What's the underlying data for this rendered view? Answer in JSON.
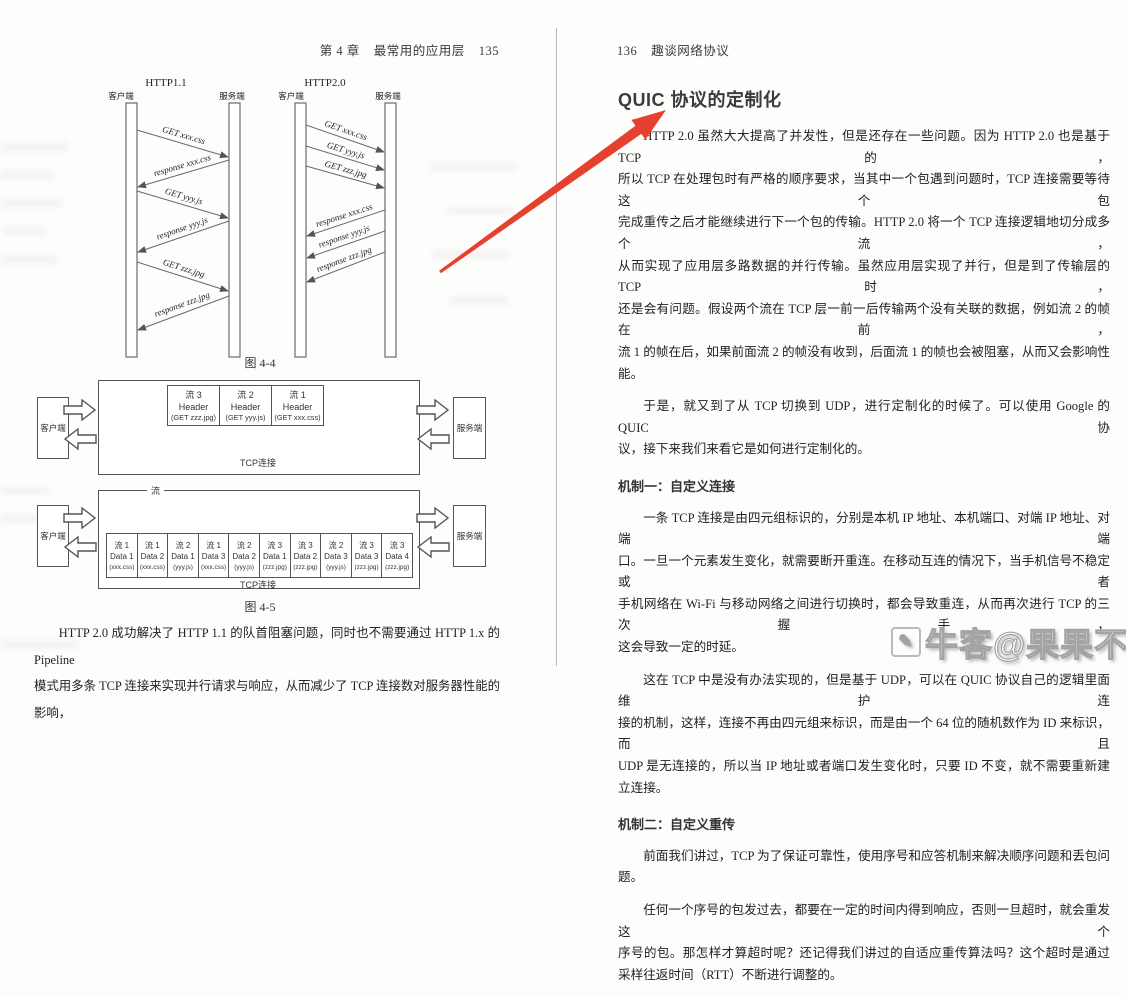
{
  "book": {
    "left_header": {
      "chapter": "第 4 章",
      "section": "最常用的应用层",
      "page": "135"
    },
    "right_header": {
      "page": "136",
      "title": "趣谈网络协议"
    }
  },
  "fig44": {
    "caption": "图 4-4",
    "http11": {
      "title": "HTTP1.1",
      "client": "客户端",
      "server": "服务端",
      "messages": [
        "GET xxx.css",
        "response xxx.css",
        "GET yyy.js",
        "response yyy.js",
        "GET zzz.jpg",
        "response zzz.jpg"
      ]
    },
    "http20": {
      "title": "HTTP2.0",
      "client": "客户端",
      "server": "服务端",
      "messages": [
        "GET xxx.css",
        "GET yyy.js",
        "GET zzz.jpg",
        "response xxx.css",
        "response yyy.js",
        "response zzz.jpg"
      ]
    }
  },
  "fig45": {
    "caption": "图 4-5",
    "client": "客户端",
    "server": "服务端",
    "tcp_label": "TCP连接",
    "stream_label": "流",
    "header_boxes": [
      {
        "stream": "流 3",
        "mid": "Header",
        "payload": "(GET zzz.jpg)"
      },
      {
        "stream": "流 2",
        "mid": "Header",
        "payload": "(GET yyy.js)"
      },
      {
        "stream": "流 1",
        "mid": "Header",
        "payload": "(GET xxx.css)"
      }
    ],
    "data_boxes": [
      {
        "stream": "流 1",
        "mid": "Data 1",
        "payload": "(xxx.css)"
      },
      {
        "stream": "流 1",
        "mid": "Data 2",
        "payload": "(xxx.css)"
      },
      {
        "stream": "流 2",
        "mid": "Data 1",
        "payload": "(yyy.js)"
      },
      {
        "stream": "流 1",
        "mid": "Data 3",
        "payload": "(xxx.css)"
      },
      {
        "stream": "流 2",
        "mid": "Data 2",
        "payload": "(yyy.js)"
      },
      {
        "stream": "流 3",
        "mid": "Data 1",
        "payload": "(zzz.jpg)"
      },
      {
        "stream": "流 3",
        "mid": "Data 2",
        "payload": "(zzz.jpg)"
      },
      {
        "stream": "流 2",
        "mid": "Data 3",
        "payload": "(yyy.js)"
      },
      {
        "stream": "流 3",
        "mid": "Data 3",
        "payload": "(zzz.jpg)"
      },
      {
        "stream": "流 3",
        "mid": "Data 4",
        "payload": "(zzz.jpg)"
      }
    ]
  },
  "left_text": {
    "lines": [
      "HTTP 2.0 成功解决了 HTTP 1.1 的队首阻塞问题，同时也不需要通过 HTTP 1.x 的 Pipeline",
      "模式用多条 TCP 连接来实现并行请求与响应，从而减少了 TCP 连接数对服务器性能的影响，"
    ]
  },
  "right_page": {
    "title": "QUIC 协议的定制化",
    "p1": {
      "lines": [
        "HTTP 2.0 虽然大大提高了并发性，但是还存在一些问题。因为 HTTP 2.0 也是基于 TCP 的，",
        "所以 TCP 在处理包时有严格的顺序要求，当其中一个包遇到问题时，TCP 连接需要等待这个包",
        "完成重传之后才能继续进行下一个包的传输。HTTP 2.0 将一个 TCP 连接逻辑地切分成多个流，",
        "从而实现了应用层多路数据的并行传输。虽然应用层实现了并行，但是到了传输层的 TCP 时，",
        "还是会有问题。假设两个流在 TCP 层一前一后传输两个没有关联的数据，例如流 2 的帧在前，",
        "流 1 的帧在后，如果前面流 2 的帧没有收到，后面流 1 的帧也会被阻塞，从而又会影响性能。"
      ]
    },
    "p2": {
      "lines": [
        "于是，就又到了从 TCP 切换到 UDP，进行定制化的时候了。可以使用 Google 的 QUIC 协",
        "议，接下来我们来看它是如何进行定制化的。"
      ]
    },
    "h1": "机制一：自定义连接",
    "p3": {
      "lines": [
        "一条 TCP 连接是由四元组标识的，分别是本机 IP 地址、本机端口、对端 IP 地址、对端端",
        "口。一旦一个元素发生变化，就需要断开重连。在移动互连的情况下，当手机信号不稳定或者",
        "手机网络在 Wi-Fi 与移动网络之间进行切换时，都会导致重连，从而再次进行 TCP 的三次握手，",
        "这会导致一定的时延。"
      ]
    },
    "p4": {
      "lines": [
        "这在 TCP 中是没有办法实现的，但是基于 UDP，可以在 QUIC 协议自己的逻辑里面维护连",
        "接的机制，这样，连接不再由四元组来标识，而是由一个 64 位的随机数作为 ID 来标识，而且",
        "UDP 是无连接的，所以当 IP 地址或者端口发生变化时，只要 ID 不变，就不需要重新建立连接。"
      ]
    },
    "h2": "机制二：自定义重传",
    "p5": {
      "lines": [
        "前面我们讲过，TCP 为了保证可靠性，使用序号和应答机制来解决顺序问题和丢包问题。"
      ]
    },
    "p6": {
      "lines": [
        "任何一个序号的包发过去，都要在一定的时间内得到响应，否则一旦超时，就会重发这个",
        "序号的包。那怎样才算超时呢？还记得我们讲过的自适应重传算法吗？这个超时是通过",
        "采样往返时间（RTT）不断进行调整的。"
      ]
    }
  },
  "annotation": {
    "arrow_color": "#e5412e"
  },
  "watermark": {
    "text": "牛客@果果不戴",
    "icon": "✎"
  }
}
